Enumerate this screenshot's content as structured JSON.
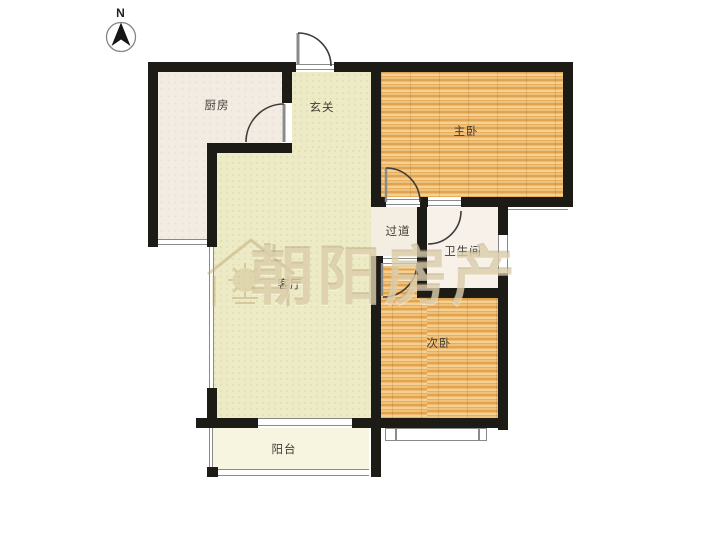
{
  "compass": {
    "label": "N"
  },
  "watermark": {
    "brand": "朝阳房产",
    "logo": "house-sun-logo"
  },
  "rooms": {
    "kitchen": "厨房",
    "entry": "玄关",
    "master_bedroom": "主卧",
    "hallway": "过道",
    "bathroom": "卫生间",
    "living_room": "客厅",
    "second_bedroom": "次卧",
    "balcony": "阳台"
  },
  "colors": {
    "wall": "#1d1b16",
    "wood_floor": "#e8b164",
    "living_floor": "#edeac6",
    "kitchen_floor": "#f3ece3",
    "bathroom_floor": "#f7f1ea",
    "balcony_floor": "#f7f4df",
    "watermark": "#cbb489",
    "thin_line": "#8a8a8a",
    "background": "#ffffff"
  }
}
